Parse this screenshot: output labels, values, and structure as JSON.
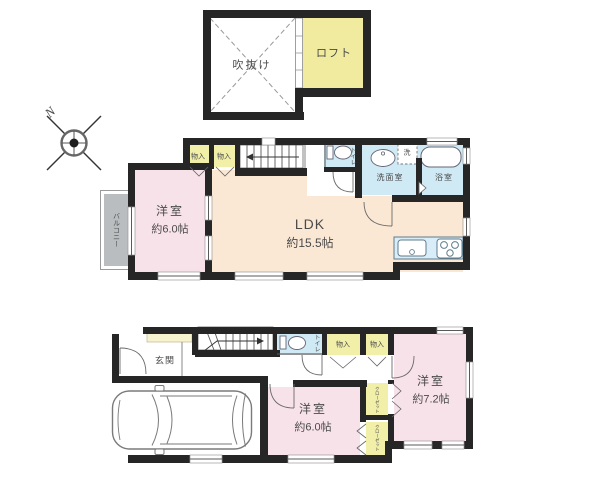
{
  "compass": {
    "north_label": "N"
  },
  "loft_floor": {
    "void_label": "吹抜け",
    "loft_label": "ロフト"
  },
  "floor2": {
    "storage1_label": "物入",
    "storage2_label": "物入",
    "toilet_label": "トイレ",
    "washroom_label": "洗面室",
    "washer_label": "洗",
    "bathroom_label": "浴室",
    "bedroom": {
      "name": "洋室",
      "size": "約6.0帖"
    },
    "ldk": {
      "name": "LDK",
      "size": "約15.5帖"
    },
    "balcony_label": "バルコニー"
  },
  "floor1": {
    "entrance_label": "玄関",
    "toilet_label": "トイレ",
    "storage1_label": "物入",
    "storage2_label": "物入",
    "bedroom1": {
      "name": "洋室",
      "size": "約7.2帖"
    },
    "bedroom2": {
      "name": "洋室",
      "size": "約6.0帖"
    },
    "closet1_label": "クローゼット",
    "closet2_label": "クローゼット"
  },
  "colors": {
    "wall": "#262626",
    "room_pink": "#f8e2ea",
    "room_peach": "#fbe8d4",
    "storage_yellow": "#f2efa9",
    "shoebox_yellow": "#f8f3cf",
    "wet_blue": "#cfe9f5",
    "counter_blue": "#d9edf8",
    "balcony_gray": "#b9bdc0"
  }
}
